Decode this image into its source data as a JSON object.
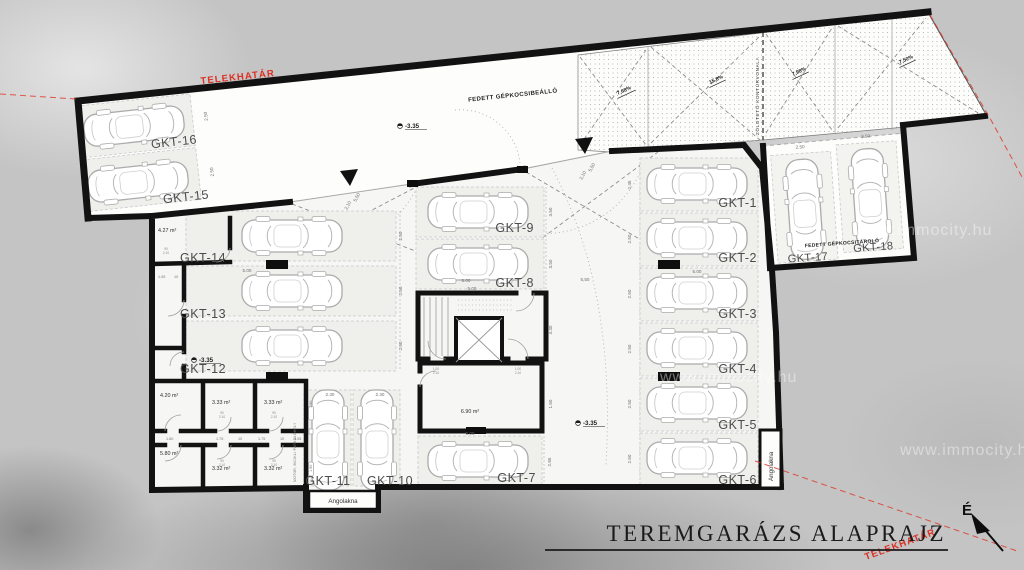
{
  "title": "TEREMGARÁZS ALAPRAJZ",
  "north_label": "É",
  "boundary_label": "TELEKHATÁR",
  "watermark": "www.immocity.hu",
  "labels": {
    "covered_carport": "FEDETT GÉPKOCSIBEÁLLÓ",
    "covered_garage": "FEDETT GÉPKOCSITÁROLÓ",
    "green_roof_contour": "ZÖLDTETŐ KONTÚRVONALA",
    "light_well": "Angolakna",
    "moto_parking": "MOTOR, BICIKLI PARKOLÓHELY",
    "level": "-3.35"
  },
  "stalls": [
    "GKT-1",
    "GKT-2",
    "GKT-3",
    "GKT-4",
    "GKT-5",
    "GKT-6",
    "GKT-7",
    "GKT-8",
    "GKT-9",
    "GKT-10",
    "GKT-11",
    "GKT-12",
    "GKT-13",
    "GKT-14",
    "GKT-15",
    "GKT-16",
    "GKT-17",
    "GKT-18"
  ],
  "rooms": [
    "4.27 m²",
    "4.20 m²",
    "3.33 m²",
    "3.33 m²",
    "5.80 m²",
    "3.32 m²",
    "3.32 m²",
    "6.90 m²"
  ],
  "slopes": [
    "7,68%",
    "15,8%",
    "7,98%",
    "7,50%"
  ],
  "dims": {
    "d500": "5.00",
    "d550": "5,50",
    "d210": "2,10",
    "d250": "2.50",
    "d245": "2.45",
    "d230": "2.30",
    "d265": "2.65",
    "d430": "4.30",
    "d150": "1.50",
    "d105": "1.05",
    "d180": "1.80",
    "d175": "1.75",
    "d190": "1.90",
    "d10": "10",
    "d90": "90",
    "d100": "1.00",
    "d2_10": "2.10",
    "d350": "3.50"
  }
}
